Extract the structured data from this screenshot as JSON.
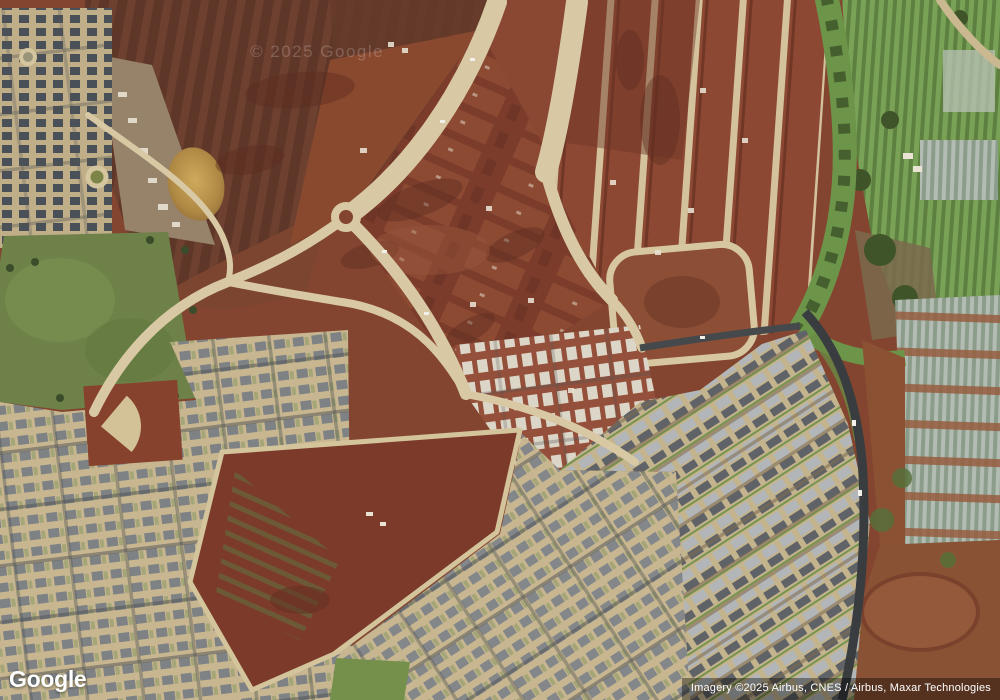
{
  "map": {
    "provider_logo": "Google",
    "watermark": "© 2025 Google",
    "attribution": "Imagery ©2025 Airbus, CNES / Airbus, Maxar Technologies",
    "view_type": "satellite"
  },
  "scene": {
    "features": [
      "plowed-farm-fields",
      "farm-equipment-yard",
      "muddy-pond",
      "older-residential-blocks",
      "large-grass-field",
      "mass-graded-construction-lots",
      "roundabout",
      "construction-roads",
      "loop-road-block",
      "riparian-greenbelt",
      "truck-farms",
      "greenhouse-crop-rows",
      "baseball-field",
      "vacant-dirt-parcel",
      "southwest-subdivision",
      "new-homes-under-construction",
      "southeast-arc-subdivision",
      "curving-arterial-road",
      "dirt-stockpile-area"
    ]
  },
  "colors": {
    "red_dirt": "#83452f",
    "dark_plowed_field": "#5f3729",
    "graded_lot_dirt": "#7b3c2b",
    "construction_road_tan": "#d8c9a4",
    "asphalt_dark": "#3a3d40",
    "grass_field_green": "#6d8148",
    "tree_green": "#3a4c2a",
    "riparian_green": "#6d9549",
    "pond_muddy_tan": "#c09a52",
    "roof_gray": "#7e8285",
    "roof_light_gray": "#b2b6b8",
    "roof_dark": "#4a5058",
    "roof_new_white": "#dcd6c8",
    "lot_tan": "#c7b690",
    "crop_row_green": "#7aa257",
    "crop_row_gray": "#b2bcb2",
    "attribution_bg": "rgba(0,0,0,0.38)",
    "overlay_text": "#ffffff"
  }
}
